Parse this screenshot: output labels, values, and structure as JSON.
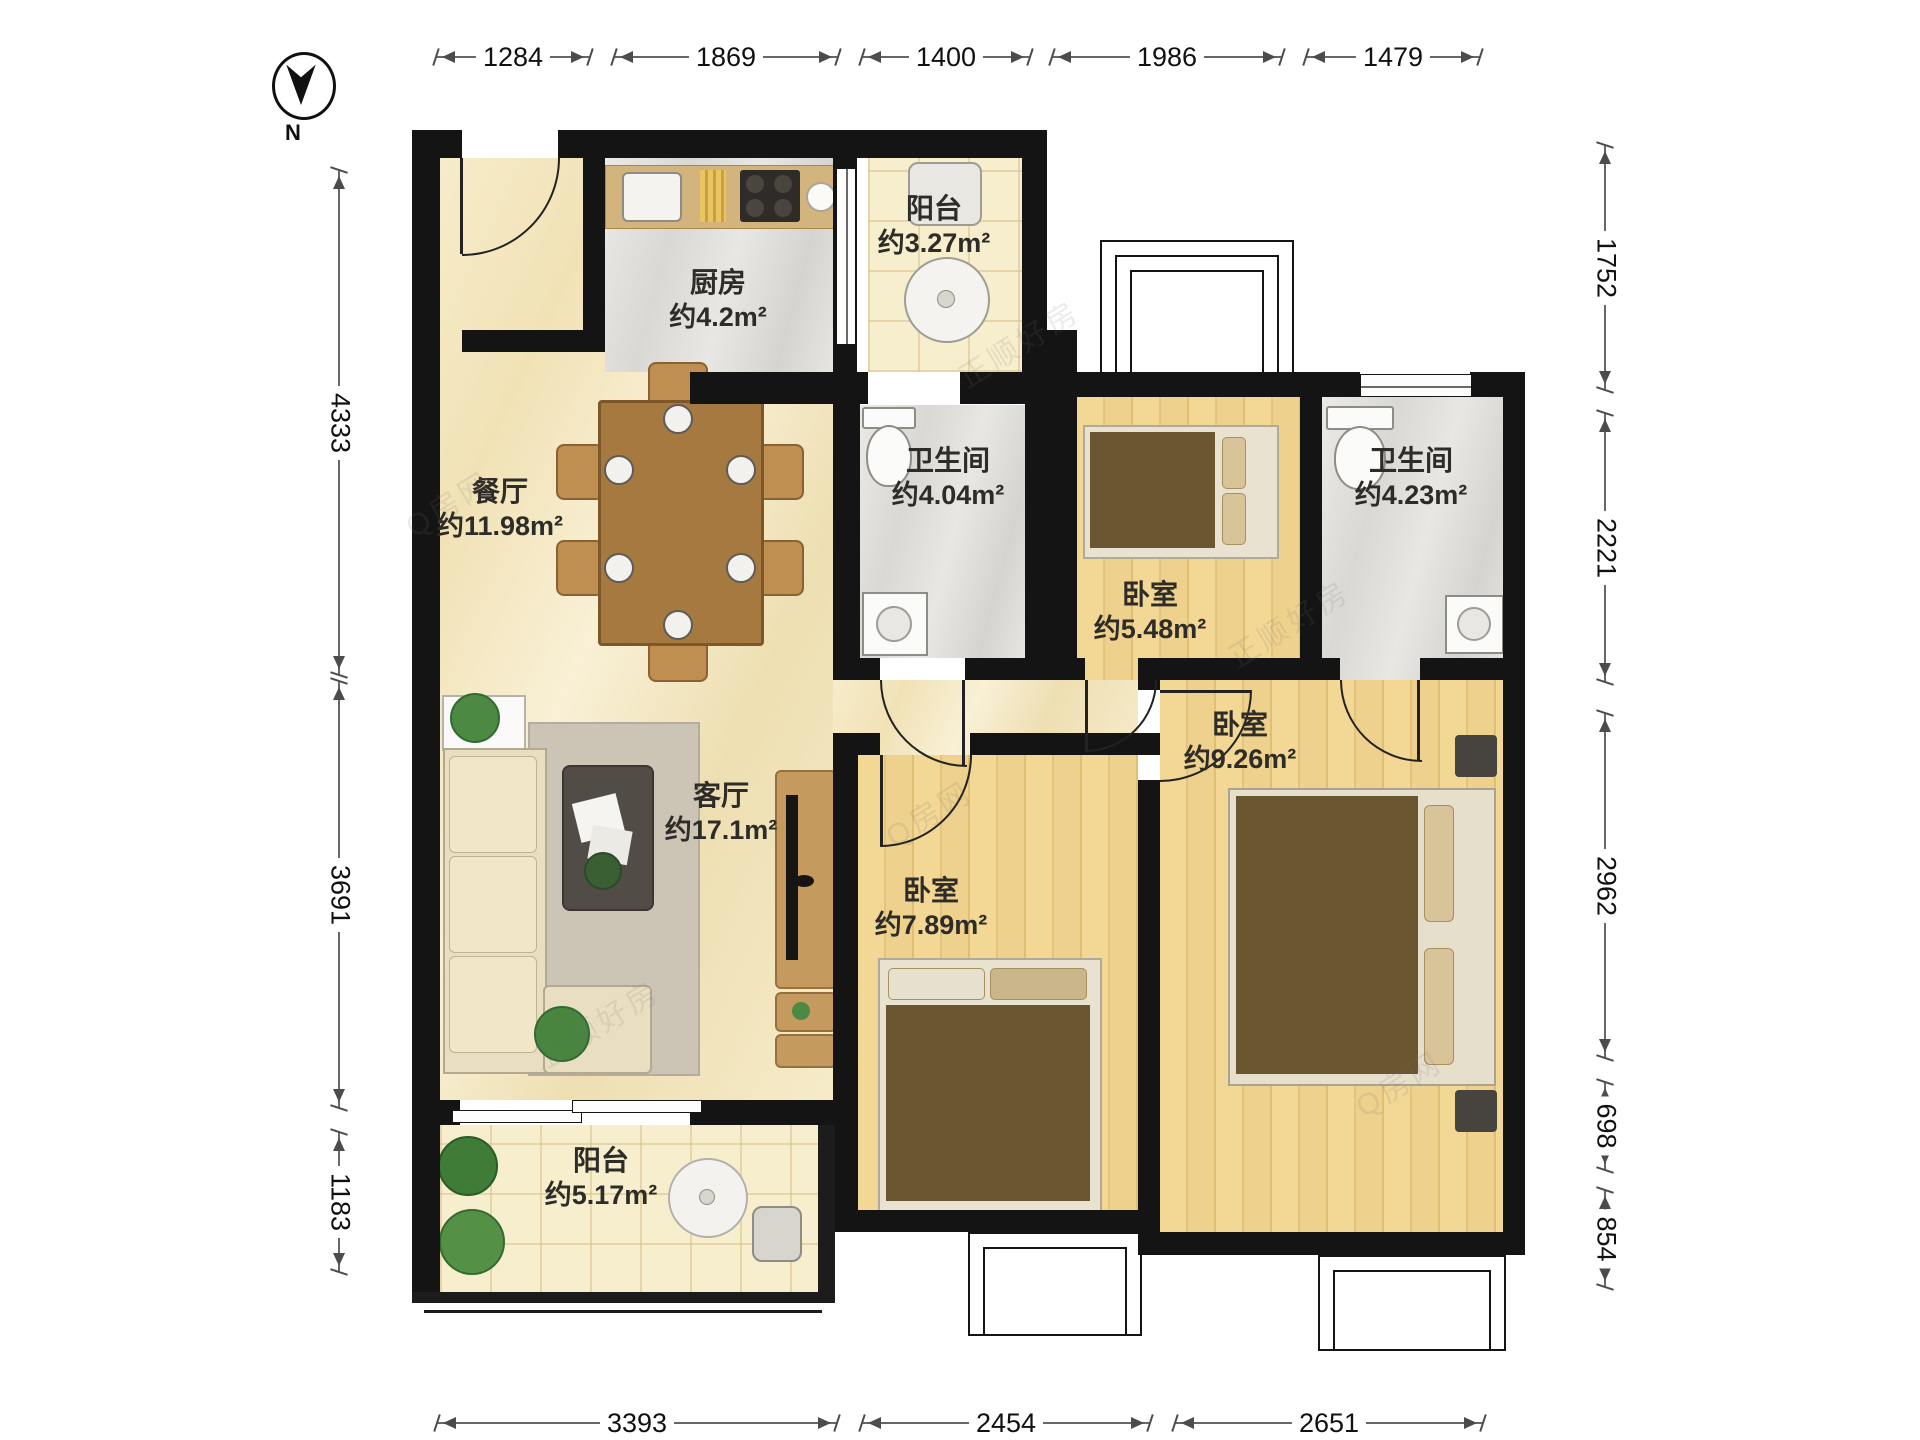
{
  "compass": {
    "north_label": "N"
  },
  "dimensions": {
    "top": [
      "1284",
      "1869",
      "1400",
      "1986",
      "1479"
    ],
    "bottom": [
      "3393",
      "2454",
      "2651"
    ],
    "left": [
      "4333",
      "3691",
      "1183"
    ],
    "right": [
      "1752",
      "2221",
      "2962",
      "698",
      "854"
    ]
  },
  "rooms": {
    "balcony_top": {
      "name": "阳台",
      "area": "约3.27m²"
    },
    "kitchen": {
      "name": "厨房",
      "area": "约4.2m²"
    },
    "dining": {
      "name": "餐厅",
      "area": "约11.98m²"
    },
    "bath_left": {
      "name": "卫生间",
      "area": "约4.04m²"
    },
    "bedroom_small": {
      "name": "卧室",
      "area": "约5.48m²"
    },
    "bath_right": {
      "name": "卫生间",
      "area": "约4.23m²"
    },
    "bedroom_mid": {
      "name": "卧室",
      "area": "约9.26m²"
    },
    "living": {
      "name": "客厅",
      "area": "约17.1m²"
    },
    "bedroom_bottom": {
      "name": "卧室",
      "area": "约7.89m²"
    },
    "balcony_bottom": {
      "name": "阳台",
      "area": "约5.17m²"
    }
  },
  "watermarks": [
    "正顺好房",
    "Q房网"
  ],
  "colors": {
    "wall": "#141414",
    "floor_cream": "#f4e8c4",
    "floor_gray": "#e2e1dd",
    "floor_wood": "#eed18c",
    "floor_tile": "#f7eecd",
    "counter_tan": "#d3b47c",
    "table_wood": "#a5793f",
    "mattress_brown": "#6b5632"
  }
}
